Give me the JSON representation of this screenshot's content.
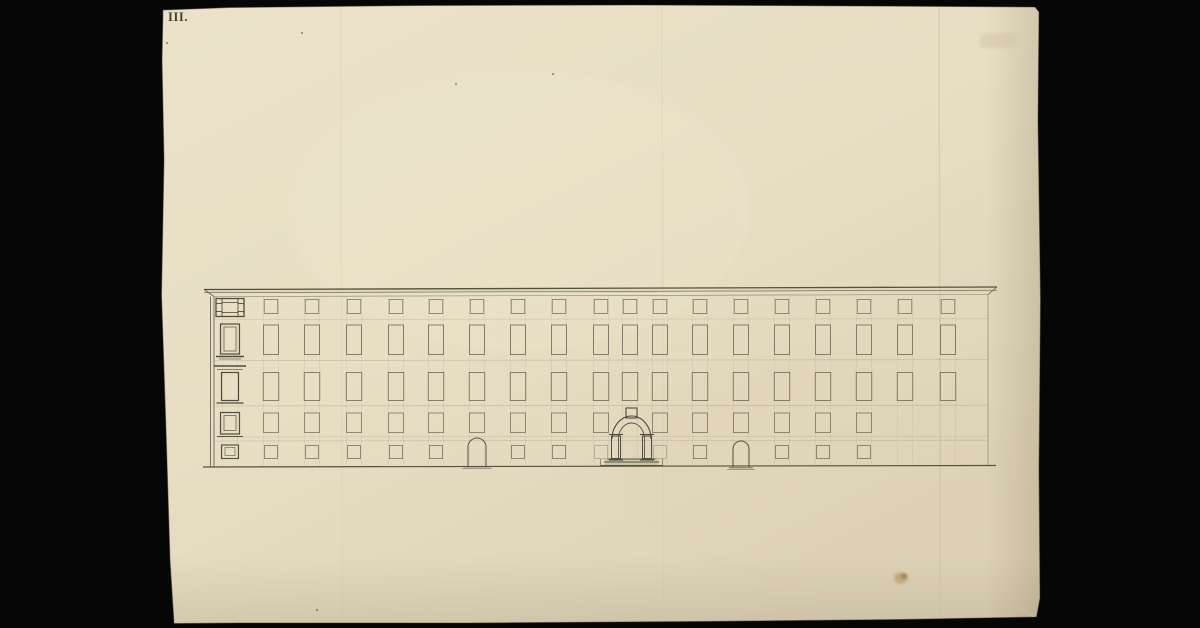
{
  "scan": {
    "background": "#060606"
  },
  "paper": {
    "inscription": "III.",
    "ink": "#453e2d",
    "base_color": "#ebe2c9",
    "mid_color": "#e7dec4",
    "edge_color": "#ddd2b5"
  },
  "facade": {
    "pencil_dark": "#524c3c",
    "pencil": "#6f6857",
    "pencil_faint": "#a59b84",
    "wash_green": "#b9bf9e",
    "wash_cornice": "#cfcdae",
    "left": 214,
    "right": 988,
    "cornice": {
      "x1": 204,
      "x2": 997,
      "y_left": 289.5,
      "y_right": 287,
      "gap": 3.2,
      "wall_top_left": 296.5,
      "wall_top_right": 294.5
    },
    "ground": {
      "x1": 203,
      "x2": 996,
      "y_left": 467,
      "y_right": 465.5
    },
    "floor_lines": [
      [
        319.5,
        0.4
      ],
      [
        360.5,
        0.55
      ],
      [
        406,
        0.55
      ],
      [
        437,
        0.4
      ],
      [
        441,
        0.5
      ]
    ],
    "rows": [
      {
        "y": 299.5,
        "h": 14,
        "w": 13.5
      },
      {
        "y": 325,
        "h": 29.5,
        "w": 15
      },
      {
        "y": 372.5,
        "h": 28,
        "w": 15.5
      },
      {
        "y": 413,
        "h": 19.5,
        "w": 15
      },
      {
        "y": 445.5,
        "h": 13,
        "w": 13
      }
    ],
    "columns": [
      {
        "x": 230,
        "detailed": true,
        "rows": [
          1,
          1,
          1,
          1,
          1
        ]
      },
      {
        "x": 271,
        "rows": [
          1,
          1,
          1,
          1,
          1
        ]
      },
      {
        "x": 312,
        "rows": [
          1,
          1,
          1,
          1,
          1
        ]
      },
      {
        "x": 354,
        "rows": [
          1,
          1,
          1,
          1,
          1
        ]
      },
      {
        "x": 396,
        "rows": [
          1,
          1,
          1,
          1,
          1
        ]
      },
      {
        "x": 436,
        "rows": [
          1,
          1,
          1,
          1,
          1
        ]
      },
      {
        "x": 477,
        "rows": [
          1,
          1,
          1,
          1,
          0
        ]
      },
      {
        "x": 518,
        "rows": [
          1,
          1,
          1,
          1,
          1
        ]
      },
      {
        "x": 559,
        "rows": [
          1,
          1,
          1,
          1,
          1
        ]
      },
      {
        "x": 601,
        "rows": [
          1,
          1,
          1,
          1,
          0.5
        ]
      },
      {
        "x": 630,
        "rows": [
          1,
          1,
          1,
          0,
          0
        ]
      },
      {
        "x": 660,
        "rows": [
          1,
          1,
          1,
          1,
          0.5
        ]
      },
      {
        "x": 700,
        "rows": [
          1,
          1,
          1,
          1,
          1
        ]
      },
      {
        "x": 741,
        "rows": [
          1,
          1,
          1,
          1,
          0
        ]
      },
      {
        "x": 782,
        "rows": [
          1,
          1,
          1,
          1,
          1
        ]
      },
      {
        "x": 823,
        "rows": [
          1,
          1,
          1,
          1,
          1
        ]
      },
      {
        "x": 864,
        "rows": [
          1,
          1,
          1,
          1,
          1
        ]
      },
      {
        "x": 905,
        "rows": [
          1,
          1,
          1,
          0,
          0
        ]
      },
      {
        "x": 948,
        "rows": [
          1,
          1,
          1,
          0,
          0
        ]
      }
    ],
    "portal": {
      "cx": 631.5,
      "keystone": {
        "x": 626,
        "y": 408,
        "w": 11,
        "h": 10
      },
      "outer": {
        "x1": 612,
        "x2": 651,
        "spring": 439,
        "ry": 23
      },
      "inner": {
        "x1": 618.5,
        "x2": 644.5,
        "spring": 439,
        "ry": 16
      },
      "pilasters": {
        "w": 9,
        "top": 436,
        "bottom": 458.5
      },
      "steps": [
        [
          459,
          24
        ],
        [
          462,
          27.5
        ],
        [
          465.5,
          31
        ]
      ],
      "wash": {
        "x": 605,
        "y": 459,
        "w": 53,
        "h": 7
      }
    },
    "doors": [
      {
        "cx": 477,
        "w": 18,
        "apex": 438,
        "base": 466,
        "sill_half": 13
      },
      {
        "cx": 741,
        "w": 16,
        "apex": 441,
        "base": 467,
        "sill_half": 12
      }
    ]
  },
  "blemishes": {
    "stain": {
      "x": 901,
      "y": 578,
      "color": "#a5814b"
    },
    "stamp": {
      "x": 980,
      "y": 33,
      "w": 36,
      "h": 15,
      "color": "#cdbf99"
    },
    "specks": [
      [
        302,
        33
      ],
      [
        168,
        580
      ],
      [
        317,
        610
      ],
      [
        456,
        84
      ],
      [
        553,
        74
      ],
      [
        167,
        43
      ]
    ],
    "creases": [
      [
        939,
        0.5
      ],
      [
        662,
        0.22
      ],
      [
        341,
        0.18
      ]
    ],
    "corner_crease": [
      1008,
      601,
      1034,
      617
    ]
  }
}
